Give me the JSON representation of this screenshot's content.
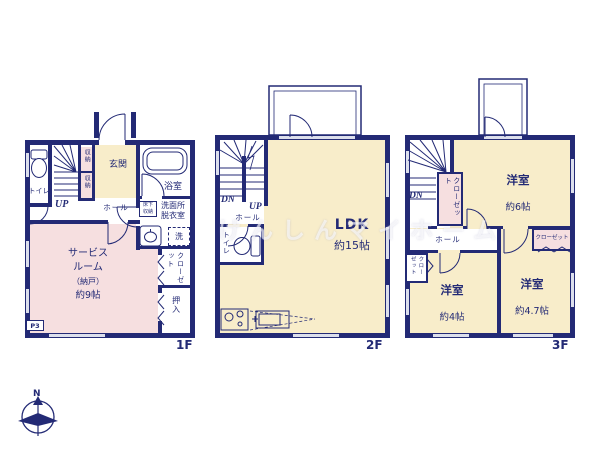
{
  "colors": {
    "wall": "#232a75",
    "cream": "#f8edca",
    "pink": "#f6dfe0",
    "window": "#dcdfec",
    "watermark": "rgba(255,255,255,0.62)"
  },
  "watermark": "けんしんマイホーム",
  "compass": {
    "north_label": "N"
  },
  "floor1": {
    "floor_label": "1F",
    "toilet": "トイレ",
    "stairs_up": "UP",
    "storage": [
      "収納",
      "収納"
    ],
    "entrance": "玄関",
    "hall": "ホール",
    "bath": "浴室",
    "washroom_lines": [
      "洗面所",
      "脱衣室"
    ],
    "underfloor_lines": [
      "床下",
      "収納"
    ],
    "washer": "洗",
    "service_lines": [
      "サービス",
      "ルーム",
      "（納戸）",
      "約9帖"
    ],
    "closet": "クローゼット",
    "oshiire": "押入",
    "parking": "P3"
  },
  "floor2": {
    "floor_label": "2F",
    "balcony": "バルコニー",
    "stairs_down": "DN",
    "stairs_up": "UP",
    "hall": "ホール",
    "toilet": "トイレ",
    "ldk": "LDK",
    "ldk_size": "約15帖"
  },
  "floor3": {
    "floor_label": "3F",
    "balcony": "バルコニー",
    "stairs_down": "DN",
    "closet_mid": "クローゼット",
    "hall": "ホール",
    "closet_top_right": "クローゼット",
    "closet_left": "クローゼット",
    "room6": "洋室",
    "room6_size": "約6帖",
    "room4": "洋室",
    "room4_size": "約4帖",
    "room47": "洋室",
    "room47_size": "約4.7帖"
  }
}
